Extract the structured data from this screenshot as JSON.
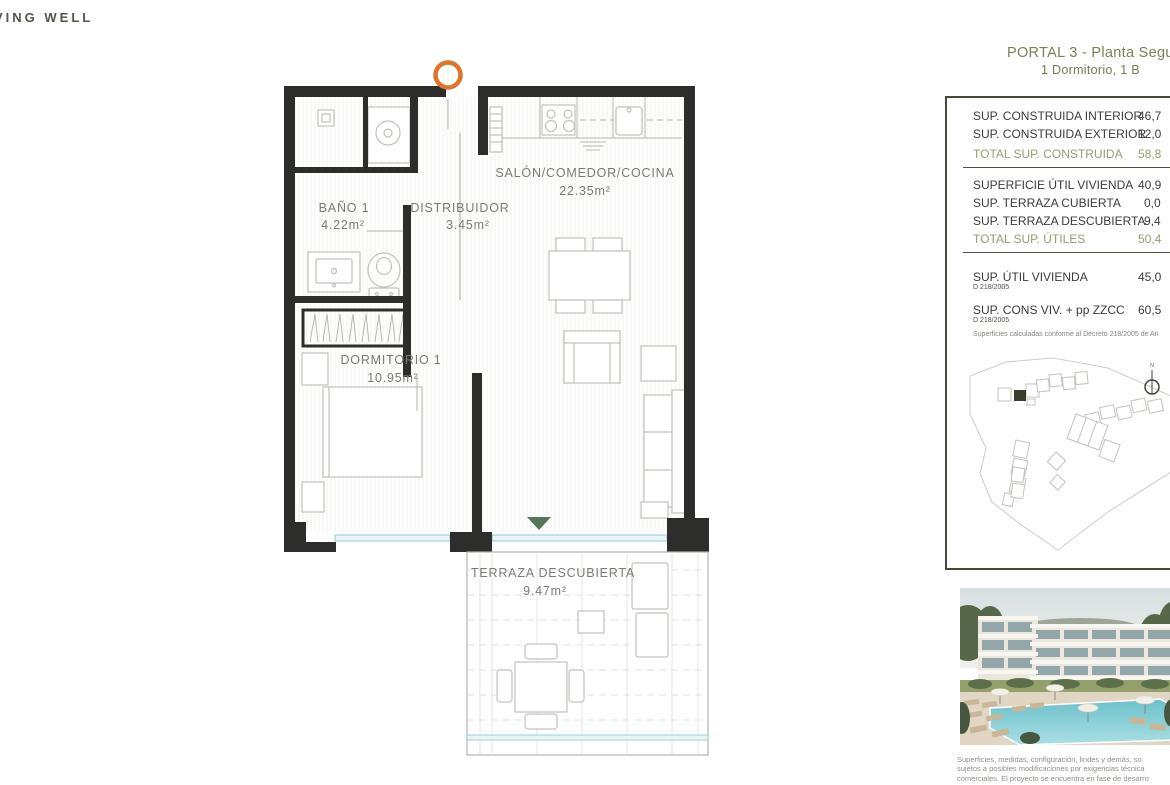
{
  "brand": {
    "logo_text": "VING WELL"
  },
  "header": {
    "title": "PORTAL 3 - Planta Segu",
    "subtitle": "1 Dormitorio, 1 B"
  },
  "floor_plan": {
    "rooms": [
      {
        "name": "SALÓN/COMEDOR/COCINA",
        "area": "22.35m²"
      },
      {
        "name": "BAÑO 1",
        "area": "4.22m²"
      },
      {
        "name": "DISTRIBUIDOR",
        "area": "3.45m²"
      },
      {
        "name": "DORMITORIO 1",
        "area": "10.95m²"
      },
      {
        "name": "TERRAZA DESCUBIERTA",
        "area": "9.47m²"
      }
    ]
  },
  "surface_table": {
    "rows": [
      {
        "label": "SUP. CONSTRUIDA INTERIOR",
        "value": "46,7"
      },
      {
        "label": "SUP. CONSTRUIDA EXTERIOR",
        "value": "12,0"
      },
      {
        "label": "TOTAL SUP. CONSTRUIDA",
        "value": "58,8"
      },
      {
        "label": "SUPERFICIE ÚTIL VIVIENDA",
        "value": "40,9"
      },
      {
        "label": "SUP. TERRAZA CUBIERTA",
        "value": "0,0"
      },
      {
        "label": "SUP. TERRAZA DESCUBIERTA",
        "value": "9,4"
      },
      {
        "label": "TOTAL SUP. ÚTILES",
        "value": "50,4"
      },
      {
        "label": "SUP. ÚTIL VIVIENDA",
        "sub": "D 218/2005",
        "value": "45,0"
      },
      {
        "label": "SUP. CONS VIV. + pp ZZCC",
        "sub": "D 218/2005",
        "value": "60,5"
      }
    ],
    "footnote": "Superficies calculadas conforme al Decreto 218/2005 de An"
  },
  "site_plan": {
    "compass_label": "N"
  },
  "disclaimer": {
    "lines": [
      "Superficies, medidas, configuración, lindes y demás, so",
      "sujetos a posibles modificaciones por exigencias técnica",
      "comerciales. El proyecto se encuentra en fase de desarro"
    ]
  },
  "colors": {
    "accent_orange": "#E0742E",
    "olive_title": "#7C7F55",
    "olive_total": "#999B72",
    "wall": "#2D2D2B",
    "window_glass": "#9CCFD3",
    "marker_green": "#56755A"
  }
}
